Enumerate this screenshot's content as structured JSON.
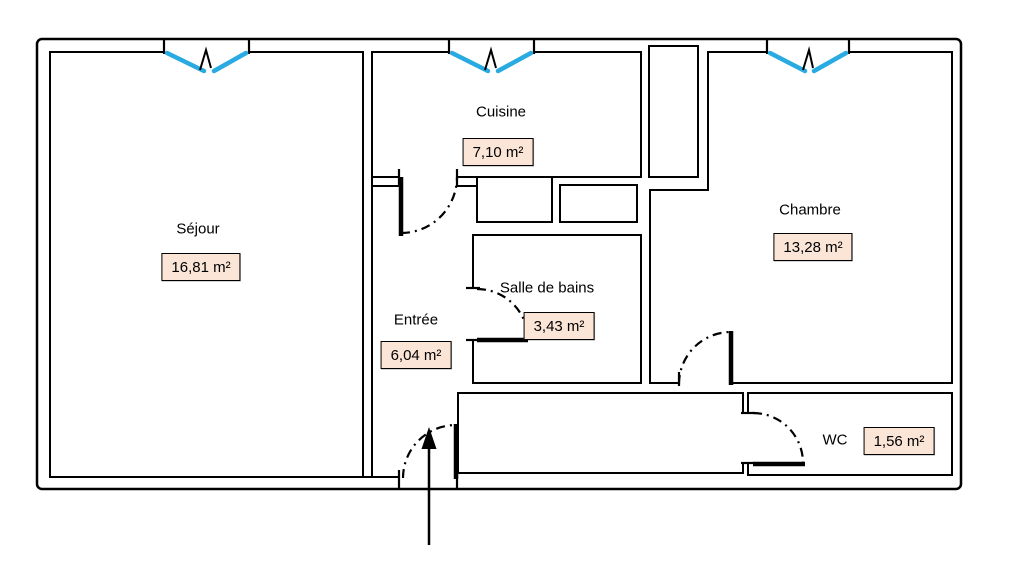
{
  "floor_plan": {
    "title": "apartment-floor-plan",
    "rooms": [
      {
        "id": "sejour",
        "name": "Séjour",
        "area": "16,81 m²"
      },
      {
        "id": "cuisine",
        "name": "Cuisine",
        "area": "7,10 m²"
      },
      {
        "id": "chambre",
        "name": "Chambre",
        "area": "13,28 m²"
      },
      {
        "id": "salle_de_bains",
        "name": "Salle de bains",
        "area": "3,43 m²"
      },
      {
        "id": "entree",
        "name": "Entrée",
        "area": "6,04 m²"
      },
      {
        "id": "wc",
        "name": "WC",
        "area": "1,56 m²"
      }
    ],
    "colors": {
      "wall": "#000000",
      "window_blue": "#29ABE2",
      "area_badge_fill": "#FBE5D6",
      "area_badge_border": "#000000"
    }
  }
}
